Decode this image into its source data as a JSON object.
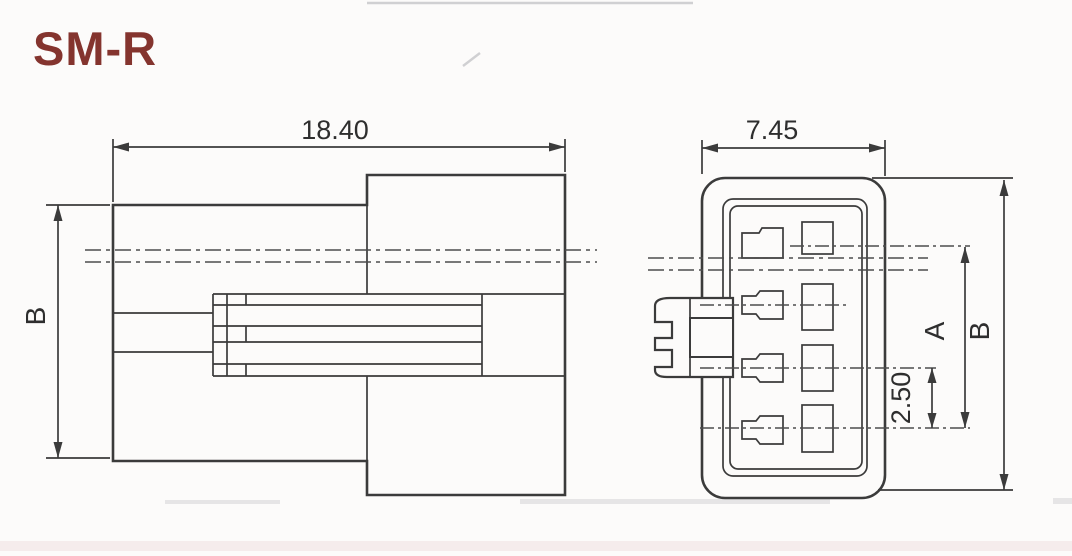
{
  "title": "SM-R",
  "colors": {
    "title": "#84342e",
    "line": "#3b3b3b",
    "dim": "#2e2e2e",
    "bg": "#fcfbfa"
  },
  "drawing": {
    "type": "connector-engineering-drawing",
    "side_view": {
      "label": "side view",
      "dim_width": "18.40",
      "dim_height": "B"
    },
    "front_view": {
      "label": "front view",
      "dim_width": "7.45",
      "dim_height": "B",
      "dim_pin_span": "A",
      "dim_pin_pitch": "2.50",
      "pin_rows": 4,
      "pin_columns": 2
    }
  }
}
